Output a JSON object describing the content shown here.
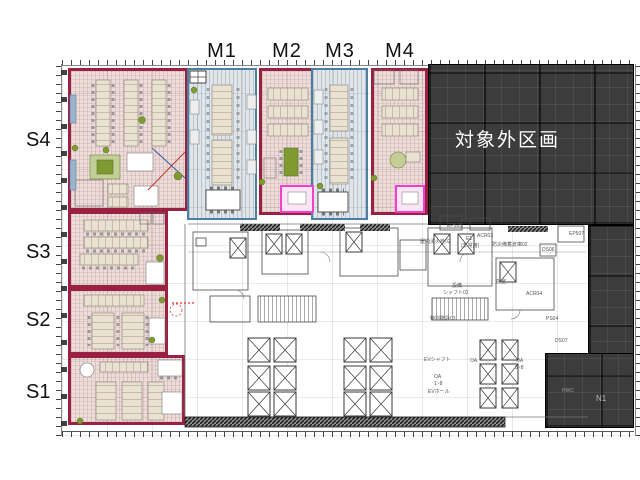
{
  "plan": {
    "top_zone_labels": [
      "M1",
      "M2",
      "M3",
      "M4"
    ],
    "left_zone_labels": [
      "S4",
      "S3",
      "S2",
      "S1"
    ],
    "excluded_area_label": "対象外区画",
    "annotations": [
      {
        "text": "EP505",
        "x": 447,
        "y": 224
      },
      {
        "text": "ACR03",
        "x": 477,
        "y": 234
      },
      {
        "text": "防災備蓄倉庫02",
        "x": 492,
        "y": 243
      },
      {
        "text": "屋内消火栓02",
        "x": 420,
        "y": 240
      },
      {
        "text": "E1",
        "x": 466,
        "y": 237
      },
      {
        "text": "(非常用)",
        "x": 461,
        "y": 244
      },
      {
        "text": "DS06",
        "x": 542,
        "y": 248
      },
      {
        "text": "EP507",
        "x": 569,
        "y": 232
      },
      {
        "text": "前室",
        "x": 496,
        "y": 280
      },
      {
        "text": "ACR04",
        "x": 526,
        "y": 292
      },
      {
        "text": "設備",
        "x": 452,
        "y": 284
      },
      {
        "text": "シャフト02",
        "x": 443,
        "y": 291
      },
      {
        "text": "特別階段03",
        "x": 430,
        "y": 317
      },
      {
        "text": "PS04",
        "x": 546,
        "y": 317
      },
      {
        "text": "DS07",
        "x": 555,
        "y": 339
      },
      {
        "text": "EVシャフト",
        "x": 424,
        "y": 358
      },
      {
        "text": "OA",
        "x": 470,
        "y": 359
      },
      {
        "text": "OA",
        "x": 516,
        "y": 359
      },
      {
        "text": "5~8",
        "x": 515,
        "y": 366
      },
      {
        "text": "OA",
        "x": 434,
        "y": 375
      },
      {
        "text": "1~8",
        "x": 434,
        "y": 382
      },
      {
        "text": "EVホール",
        "x": 428,
        "y": 390
      },
      {
        "text": "HWC",
        "x": 562,
        "y": 389,
        "color": "#9a9a9a"
      },
      {
        "text": "N1",
        "x": 596,
        "y": 395,
        "color": "#b8b8b8",
        "size": 8
      }
    ]
  },
  "colors": {
    "zone-red": "#9b2143",
    "zone-pink": "#ecdcda",
    "zone-blue": "#4d7fa3",
    "zone-bluefill": "#dfe5e9",
    "excluded-bg": "#3c3c3c",
    "excluded-text": "#ffffff",
    "highlight": "#f23fd0",
    "plant": "#7f9a30",
    "desk": "#e9e1d2",
    "line": "#4a4a4a"
  }
}
